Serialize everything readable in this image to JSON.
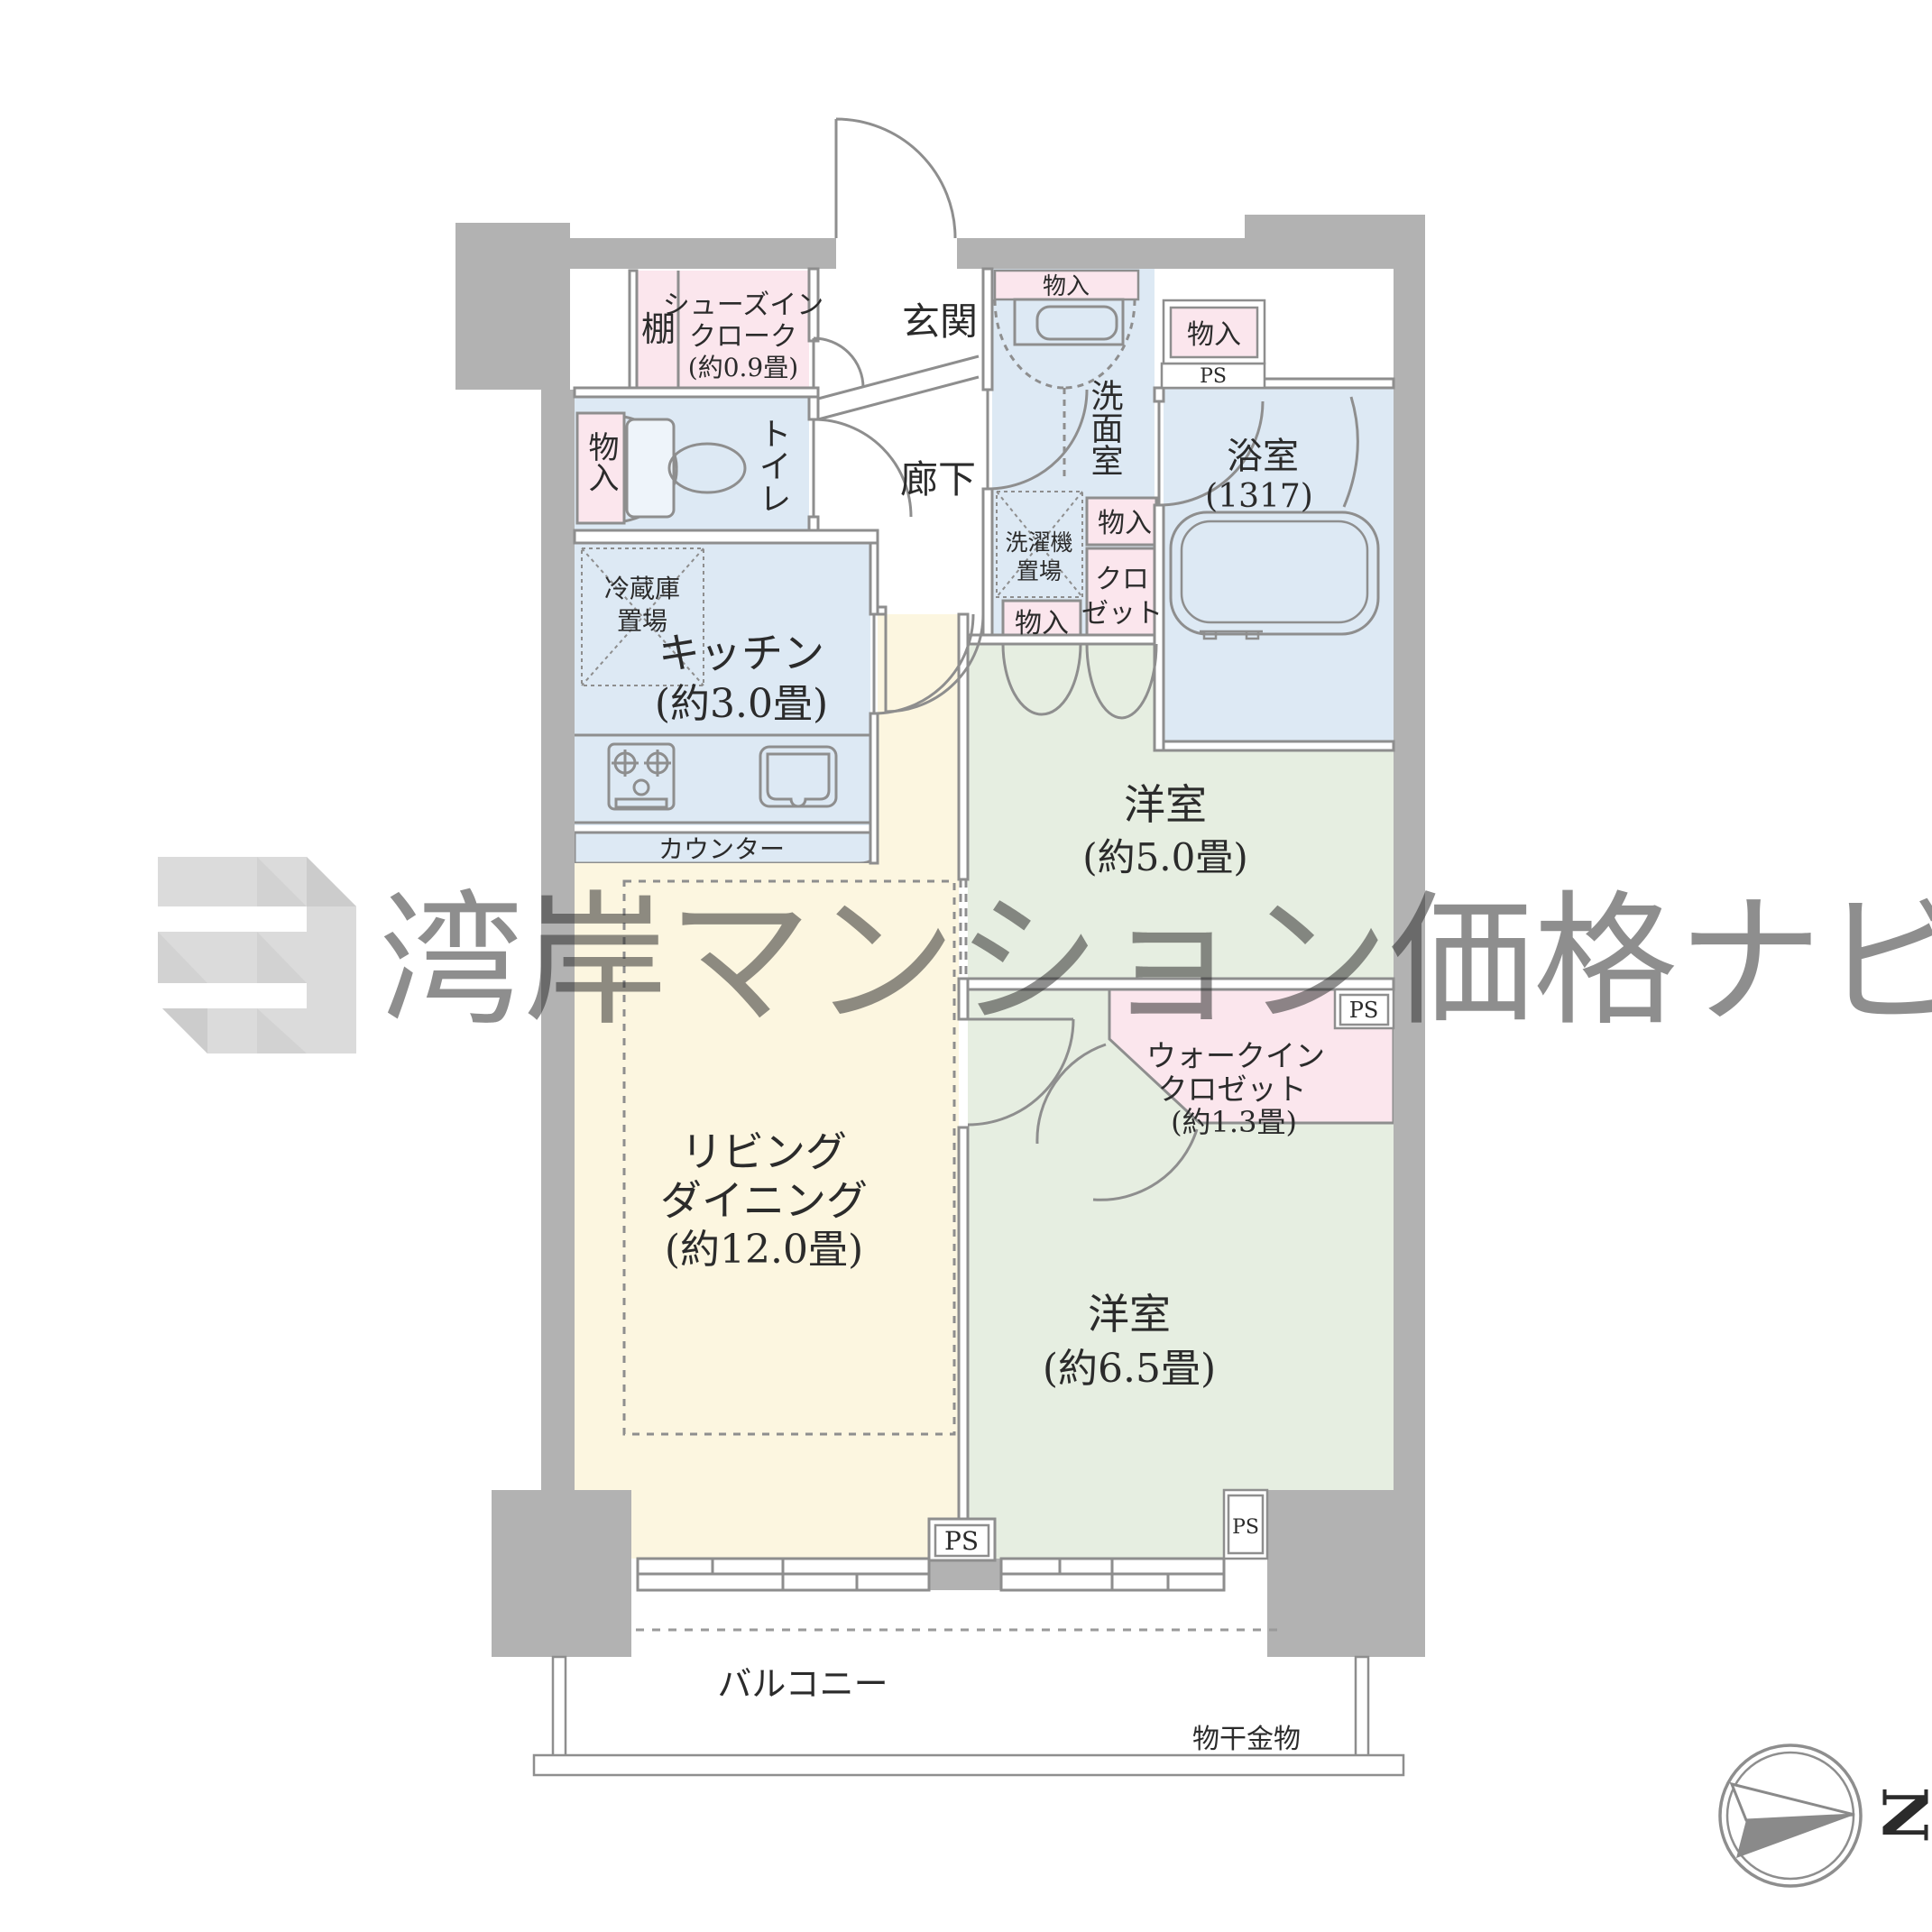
{
  "watermark": {
    "text": "湾岸マンション価格ナビ"
  },
  "compass": {
    "north": "N"
  },
  "labels": {
    "shelf": "棚",
    "sic": [
      "シューズイン",
      "クローク",
      "(約0.9畳)"
    ],
    "entrance": "玄関",
    "corridor": "廊下",
    "toilet": "トイレ",
    "storage": "物入",
    "fridge": [
      "冷蔵庫",
      "置場"
    ],
    "kitchen": [
      "キッチン",
      "(約3.0畳)"
    ],
    "counter": "カウンター",
    "washroom": "洗面室",
    "laundry": [
      "洗濯機",
      "置場"
    ],
    "closet": [
      "クロ",
      "ゼット"
    ],
    "bathroom": "浴室",
    "bathroom_size": "(1317)",
    "living": [
      "リビング",
      "ダイニング",
      "(約12.0畳)"
    ],
    "bedroom5": [
      "洋室",
      "(約5.0畳)"
    ],
    "bedroom65": [
      "洋室",
      "(約6.5畳)"
    ],
    "wic": [
      "ウォークイン",
      "クロゼット",
      "(約1.3畳)"
    ],
    "balcony": "バルコニー",
    "drying": "物干金物",
    "ps": "PS"
  },
  "colors": {
    "wall": "#b2b2b2",
    "line": "#8e8e8e",
    "pink": "#fbe6ed",
    "blue": "#dde9f4",
    "yellow": "#fcf6e0",
    "green": "#e6eee1",
    "watermark": "#c0c0c0"
  }
}
